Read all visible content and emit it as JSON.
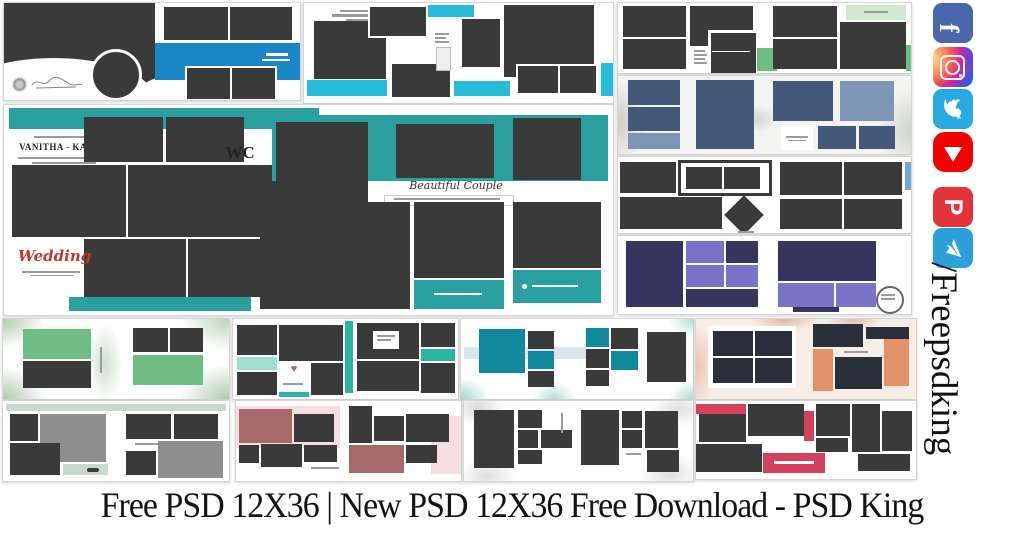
{
  "caption": {
    "text": "Free PSD 12X36 | New PSD 12X36 Free Download - PSD King"
  },
  "watermark": {
    "handle": "/Freepsdking"
  },
  "social": {
    "items": [
      {
        "id": "facebook",
        "label": "Facebook",
        "glyph": "f",
        "color": "#4a66ac"
      },
      {
        "id": "instagram",
        "label": "Instagram",
        "color": "#d6249f"
      },
      {
        "id": "twitter",
        "label": "Twitter",
        "color": "#29a9e1"
      },
      {
        "id": "youtube",
        "label": "YouTube",
        "color": "#f20000"
      },
      {
        "id": "pinterest",
        "label": "Pinterest",
        "glyph": "P",
        "color": "#e23439"
      },
      {
        "id": "telegram",
        "label": "Telegram",
        "color": "#2ba0da"
      }
    ]
  },
  "templates": {
    "vanitha": {
      "title": "VANITHA - KANNAN",
      "monogram": "WC",
      "script_left": "Wedding",
      "script_right": "Beautiful Couple"
    }
  },
  "decor": {
    "heart": "♥"
  },
  "palette": {
    "charcoal": "#3a3a3a",
    "blue": "#1b86c8",
    "cyan": "#27bcd9",
    "teal": "#2a9fa0",
    "green": "#6fbc85",
    "light_green": "#cfe8cf",
    "mint": "#9fded2",
    "teal_bright": "#2ab5a5",
    "dark_teal": "#11889b",
    "slate": "#44597a",
    "light_slate": "#7e95b6",
    "purple": "#7a74c9",
    "dark_purple": "#37345f",
    "navy": "#29303b",
    "orange": "#e2926a",
    "blush": "#f8ece6",
    "sage": "#c9d9cd",
    "gray": "#8f8f8f",
    "mauve": "#a66a6d",
    "pink": "#f6dde1",
    "crimson": "#d4415f",
    "accent_blue": "#6fa8d4",
    "light_blue": "#d9e6ee",
    "red_script": "#c0392b",
    "facebook": "#4a66ac",
    "twitter": "#29a9e1",
    "youtube": "#f20000",
    "pinterest": "#e23439",
    "telegram": "#2ba0da",
    "instagram": "#d6249f"
  }
}
